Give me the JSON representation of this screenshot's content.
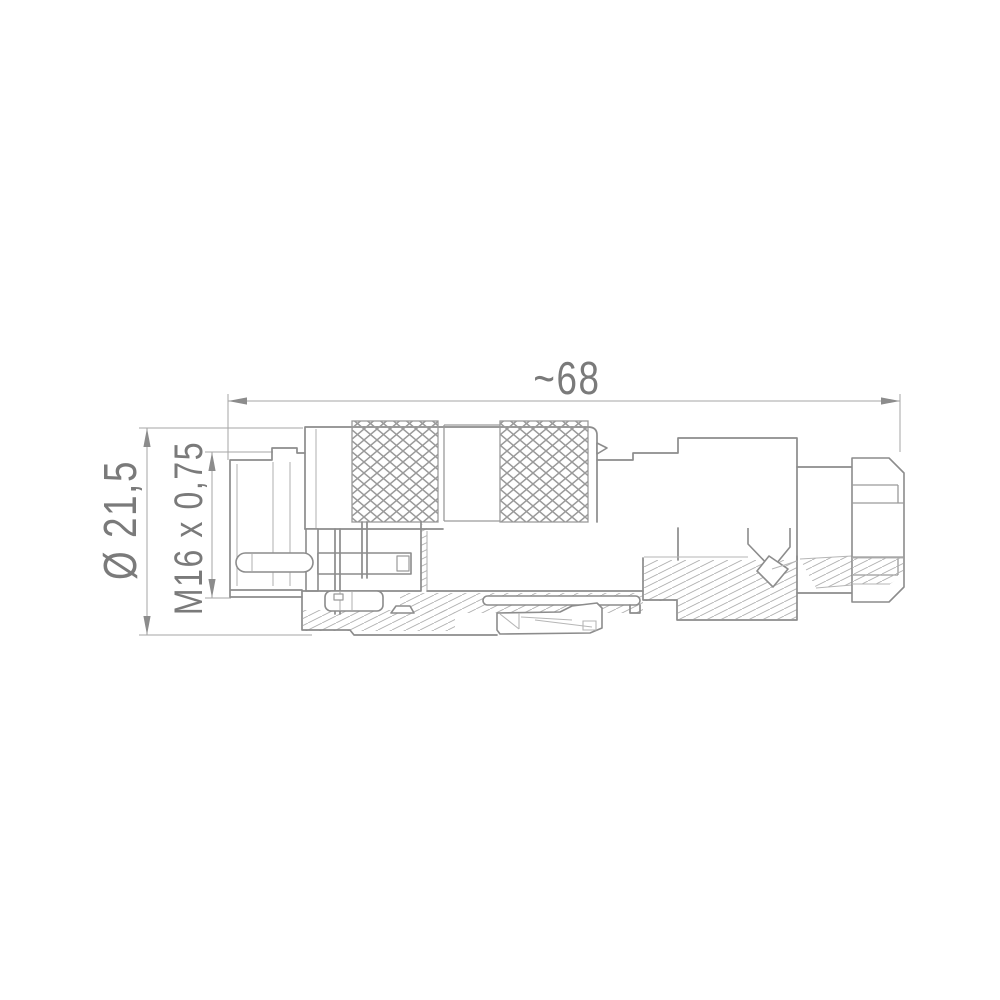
{
  "drawing": {
    "type": "technical-drawing",
    "subject": "circular-connector-side-view",
    "dimensions": {
      "length": "~68",
      "diameter": "Ø 21,5",
      "thread": "M16 x 0,75"
    },
    "colors": {
      "line": "#8c8c8c",
      "line_light": "#b6b6b6",
      "dim_line": "#a6a6a6",
      "text": "#7a7a7a",
      "knurl": "#9a9a9a",
      "hatch": "#b0b0b0",
      "background": "#ffffff"
    }
  }
}
